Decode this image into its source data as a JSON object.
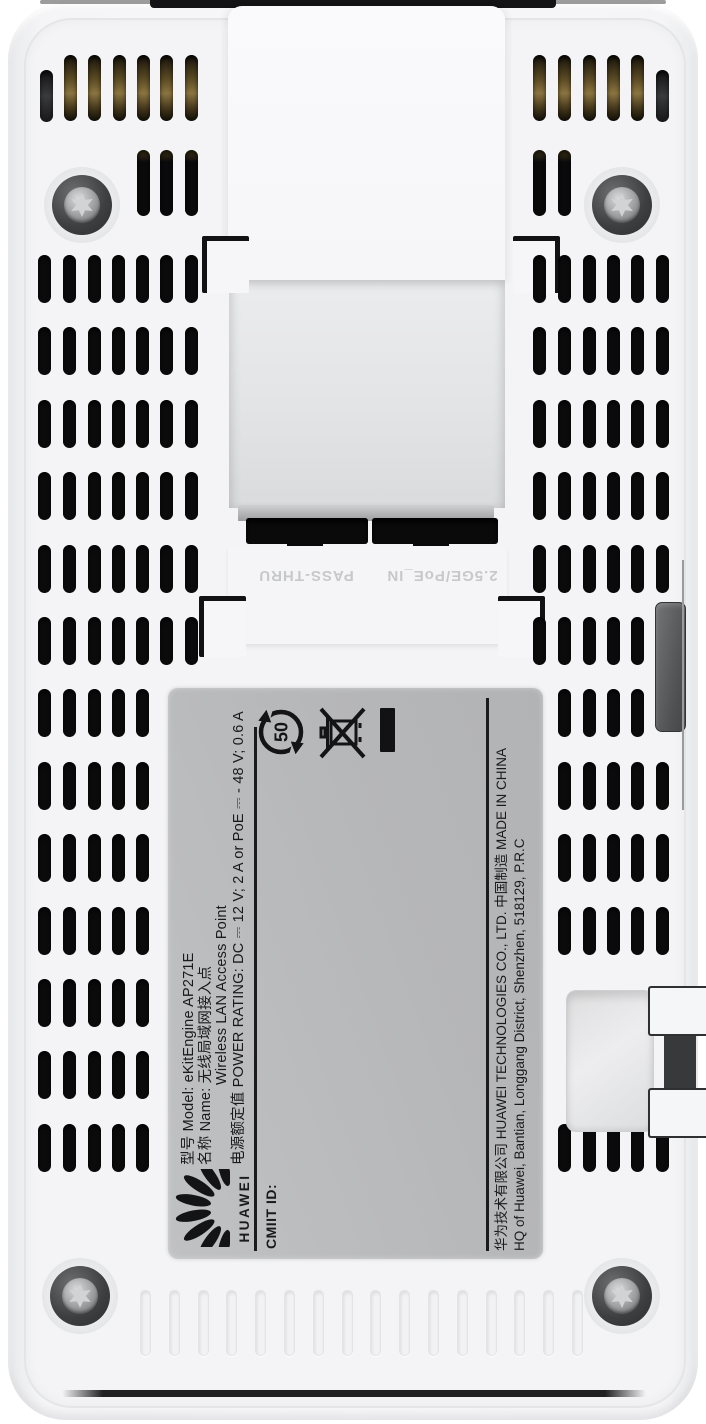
{
  "device": {
    "name": "huawei-ap271e-rear",
    "ports": {
      "poe_in_label": "2.5GE/PoE_IN",
      "pass_thru_label": "PASS-THRU"
    },
    "label": {
      "model_line": "型号 Model: eKitEngine AP271E",
      "name_line": "名称 Name: 无线局域网接入点",
      "name_line_en": "Wireless LAN Access Point",
      "power_line": "电源额定值 POWER RATING: DC ⎓ 12 V; 2 A or PoE ⎓ - 48 V; 0.6 A",
      "brand_wordmark": "HUAWEI",
      "cmiit_line": "CMIIT ID:",
      "company_line": "华为技术有限公司  HUAWEI TECHNOLOGIES CO., LTD.   中国制造  MADE IN CHINA",
      "address_line": "HQ of Huawei, Bantian, Longgang District, Shenzhen, 518129, P.R.C",
      "recycle_years": "50",
      "icon_names": [
        "huawei-flower-logo",
        "recycle-50-icon",
        "weee-crossed-bin-icon",
        "solid-bar-mark"
      ]
    },
    "colors": {
      "body": "#f4f4f6",
      "label_bg": "#b8b9bb",
      "label_text": "#1a1a1c",
      "vent_slot": "#0b0b0c",
      "gold_vent": "#8a7440",
      "port_text": "#c7c8ca",
      "connector_gray": "#58595b"
    }
  }
}
